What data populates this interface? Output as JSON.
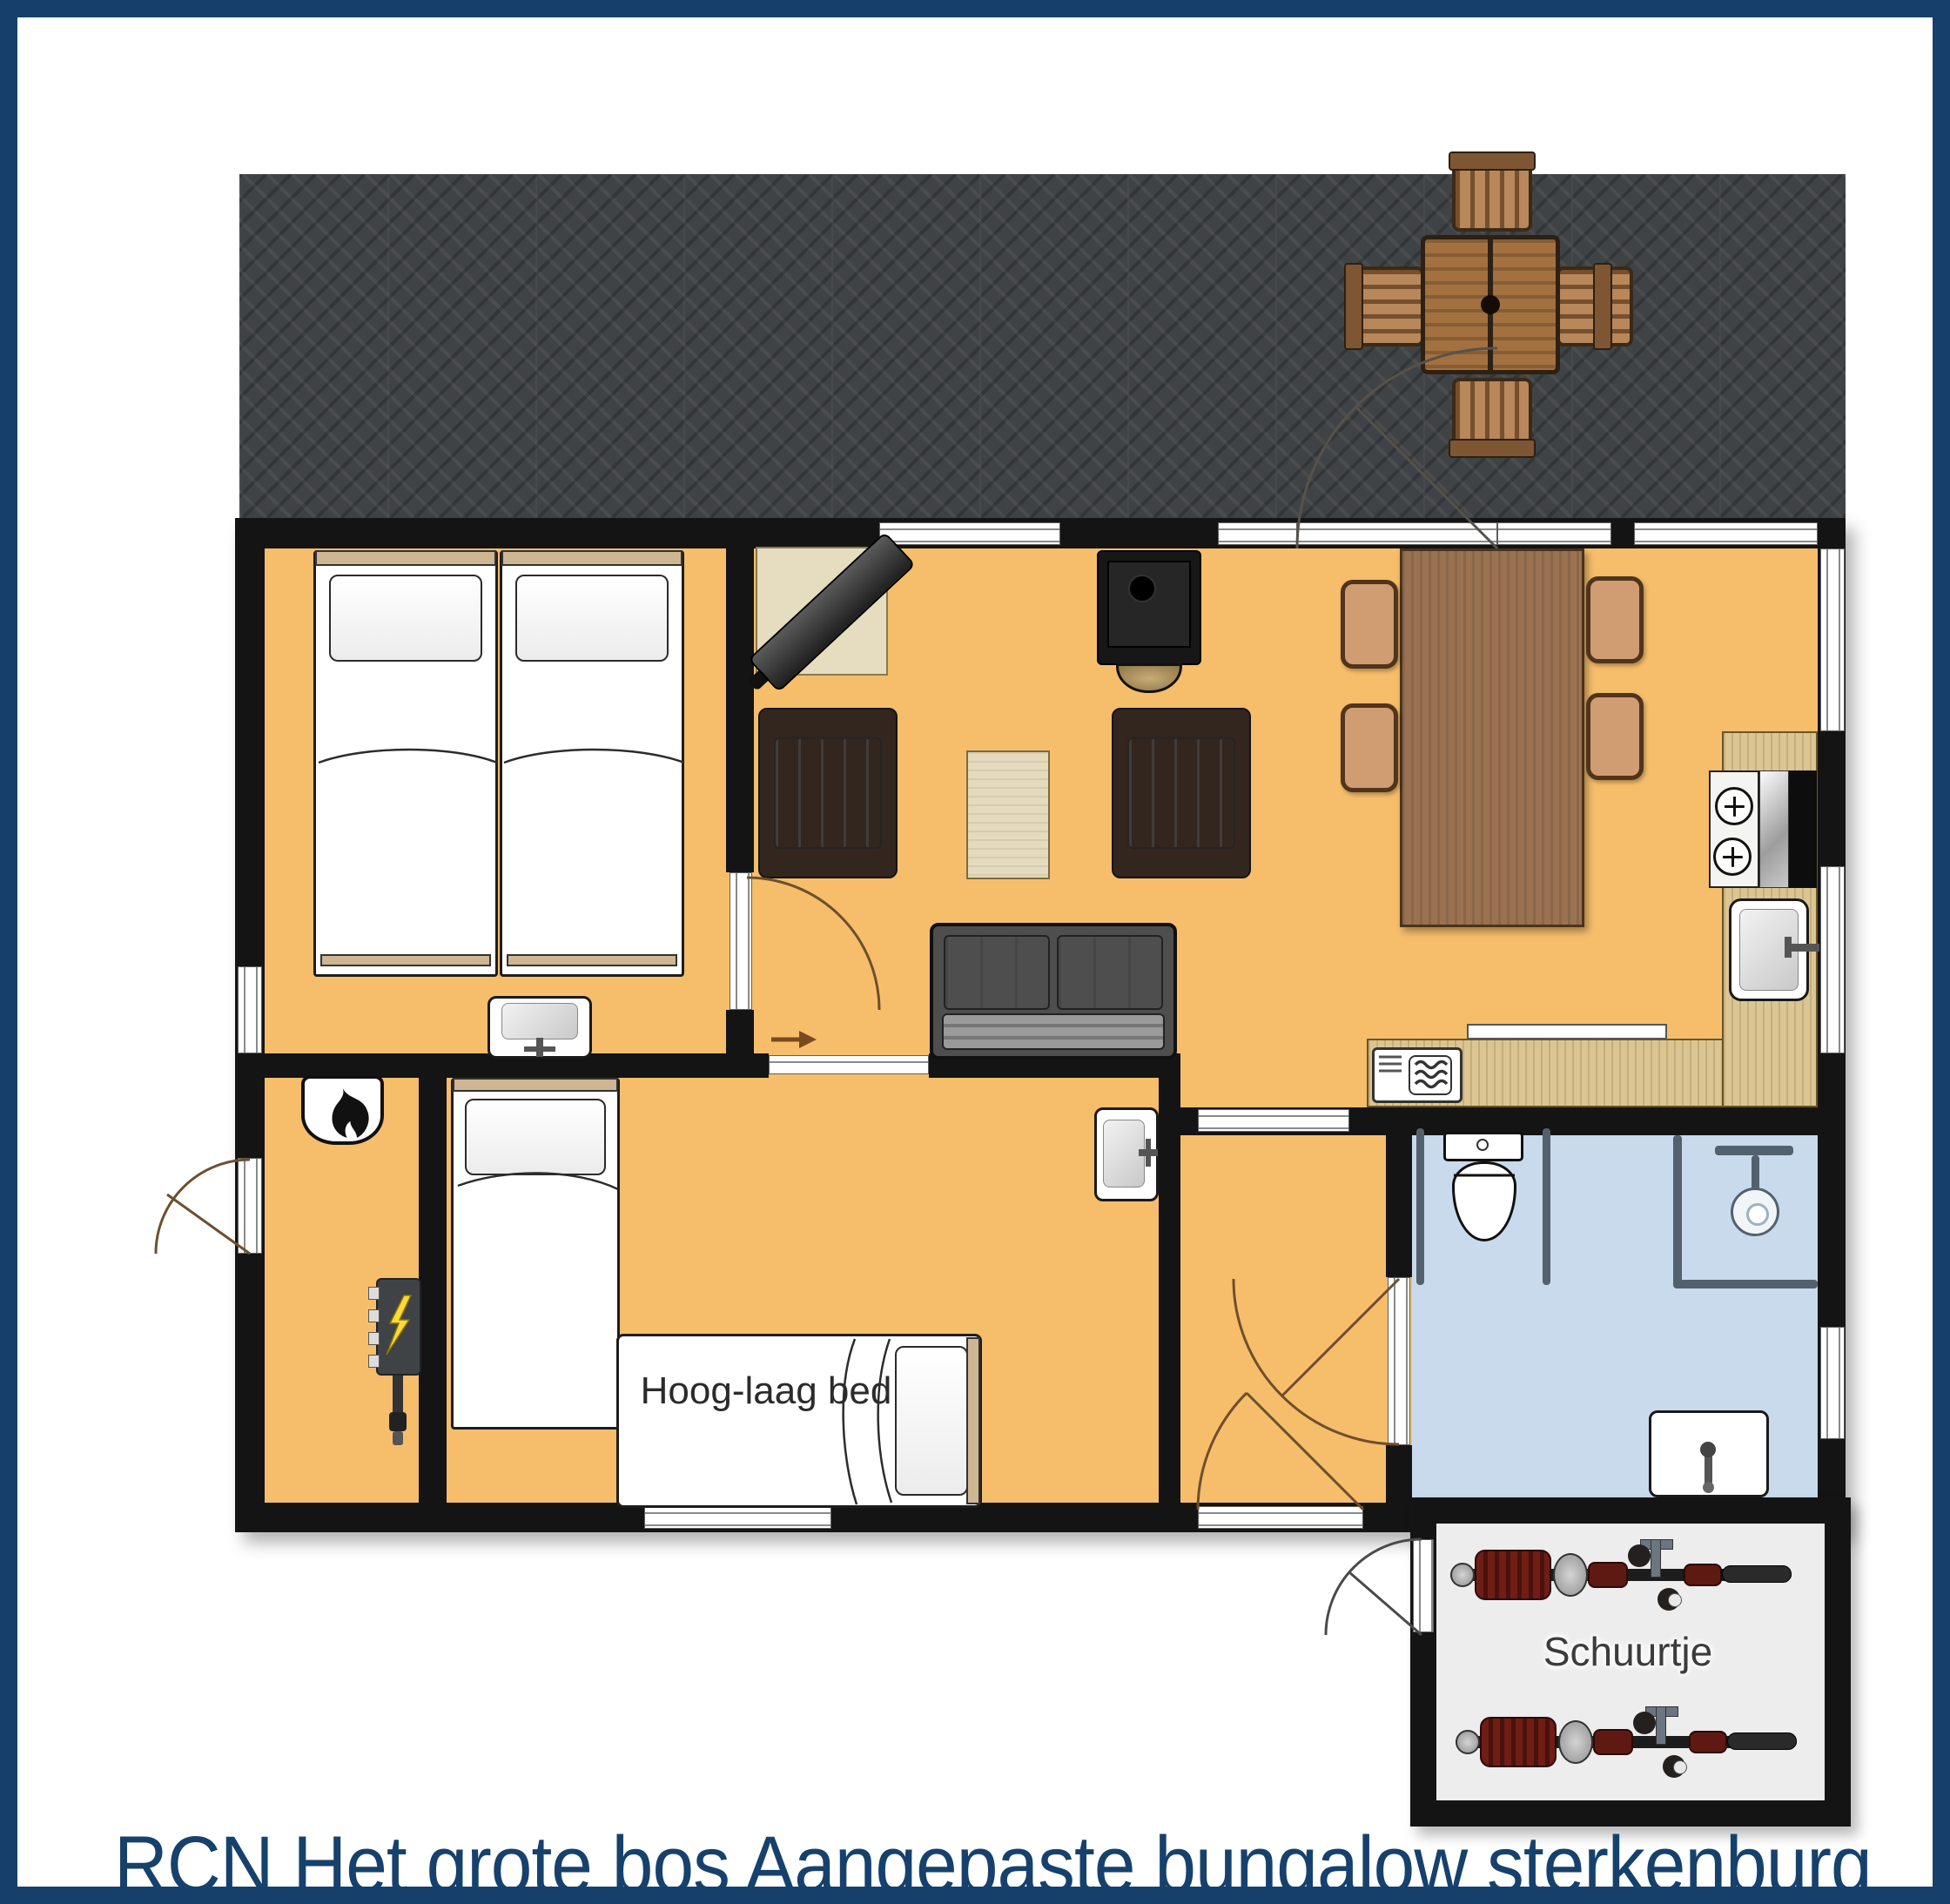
{
  "title": {
    "text": "RCN Het grote bos Aangepaste bungalow sterkenburg",
    "color": "#16416d"
  },
  "labels": {
    "hoog_laag_bed": "Hoog-laag bed",
    "schuurtje": "Schuurtje"
  },
  "colors": {
    "frame_border": "#16406b",
    "floor_orange": "#f6be6b",
    "bathroom_blue": "#c8daec",
    "terrace_gray": "#404346",
    "wall_black": "#141414",
    "kitchen_counter": "#dbc693",
    "dining_table": "#9a7252",
    "patio_wood": "#a3713f",
    "shed_floor": "#ededed",
    "bike_red": "#6f1d15",
    "door_arc_brown": "#6e4f2d",
    "lightning_yellow": "#ffd83a"
  },
  "icons": [
    {
      "name": "flame-icon",
      "meaning": "heater/boiler"
    },
    {
      "name": "lightning-icon",
      "meaning": "electrical panel"
    },
    {
      "name": "steam-waves-icon",
      "meaning": "microwave"
    },
    {
      "name": "arrow-right-icon",
      "meaning": "sliding door direction"
    },
    {
      "name": "shower-head-icon",
      "meaning": "shower"
    },
    {
      "name": "burner-icon",
      "meaning": "cooktop"
    }
  ]
}
